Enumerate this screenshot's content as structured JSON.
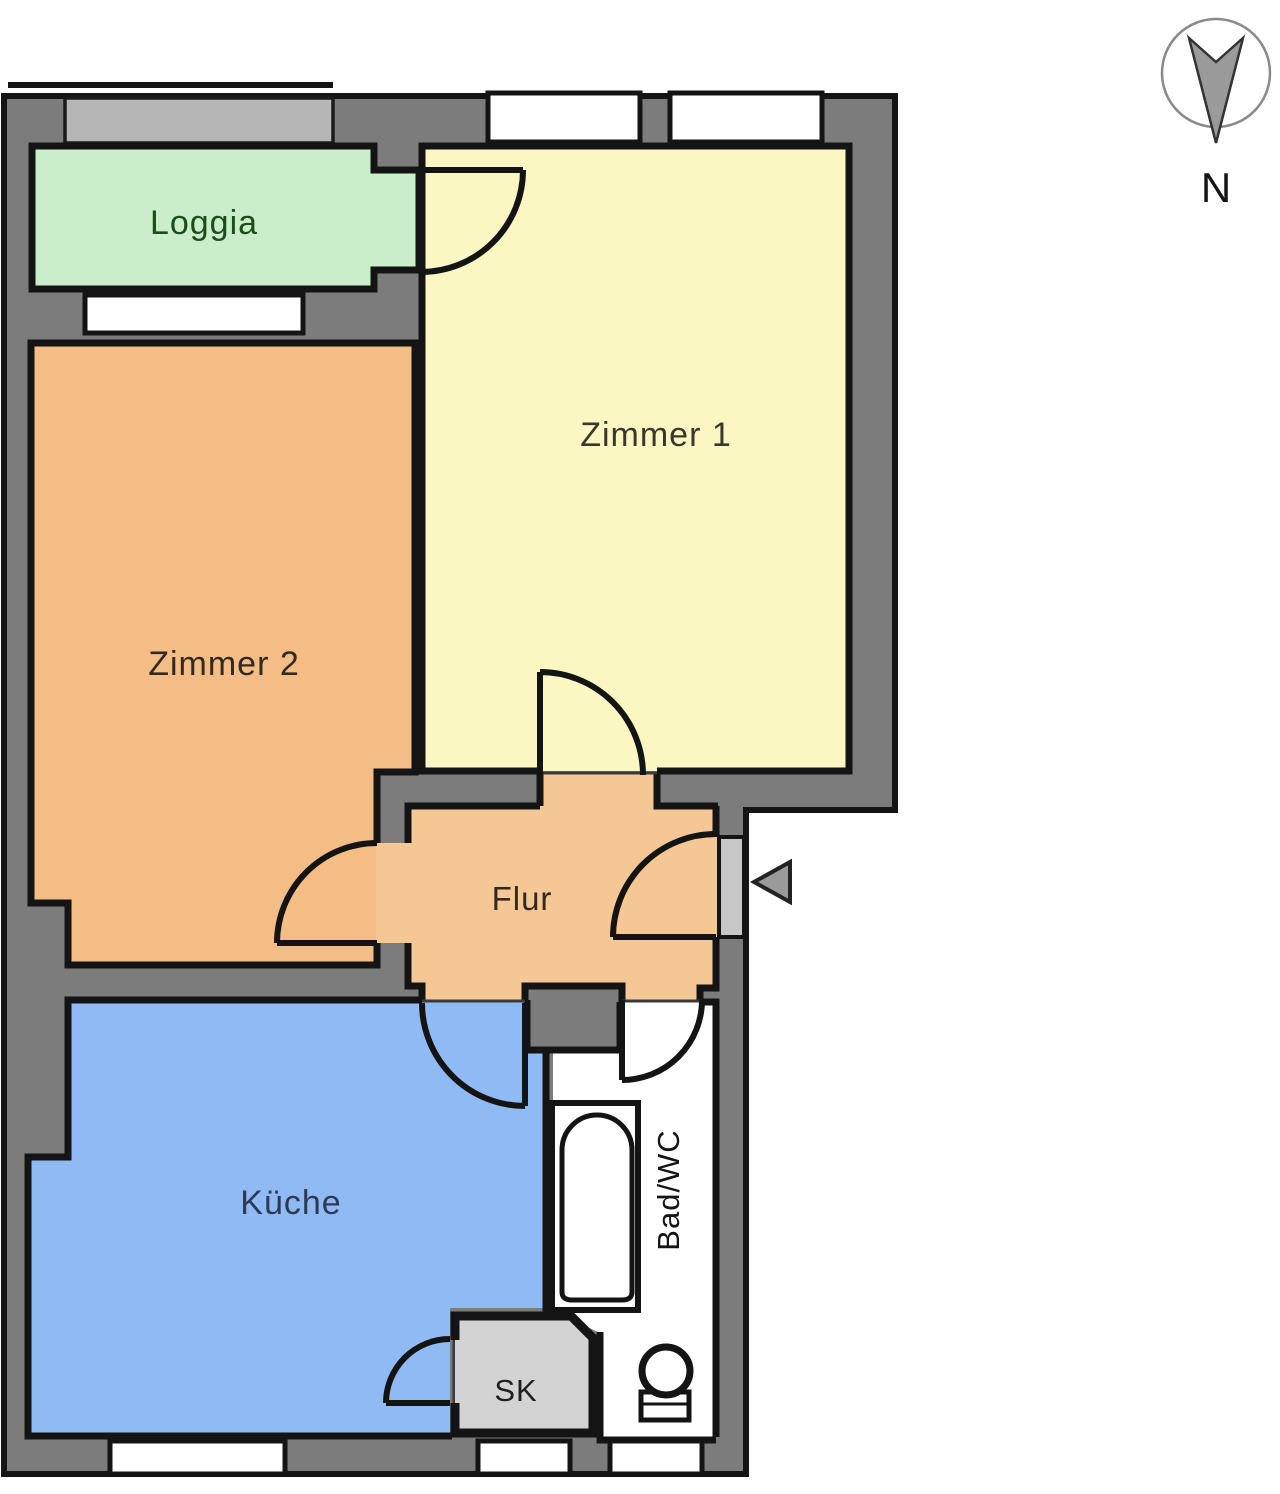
{
  "plan": {
    "rooms": {
      "loggia": {
        "label": "Loggia",
        "color": "#c9eec9",
        "label_color": "#1d4d1d"
      },
      "zimmer1": {
        "label": "Zimmer 1",
        "color": "#fbf7c3",
        "label_color": "#3a372c"
      },
      "zimmer2": {
        "label": "Zimmer 2",
        "color": "#f3bd85",
        "label_color": "#33291f"
      },
      "flur": {
        "label": "Flur",
        "color": "#f5c794",
        "label_color": "#33291f"
      },
      "kueche": {
        "label": "Küche",
        "color": "#8fbaf3",
        "label_color": "#2c3a55"
      },
      "bad": {
        "label": "Bad/WC",
        "color": "#ffffff",
        "label_color": "#141414"
      },
      "sk": {
        "label": "SK",
        "color": "#d3d3d3",
        "label_color": "#1f1f1f"
      }
    },
    "compass": {
      "label": "N"
    },
    "colors": {
      "wall": "#7c7c7c",
      "railing": "#b6b6b6",
      "outline": "#141414",
      "entry_door": "#c7c7c7",
      "arrow": "#9a9a9a"
    }
  }
}
